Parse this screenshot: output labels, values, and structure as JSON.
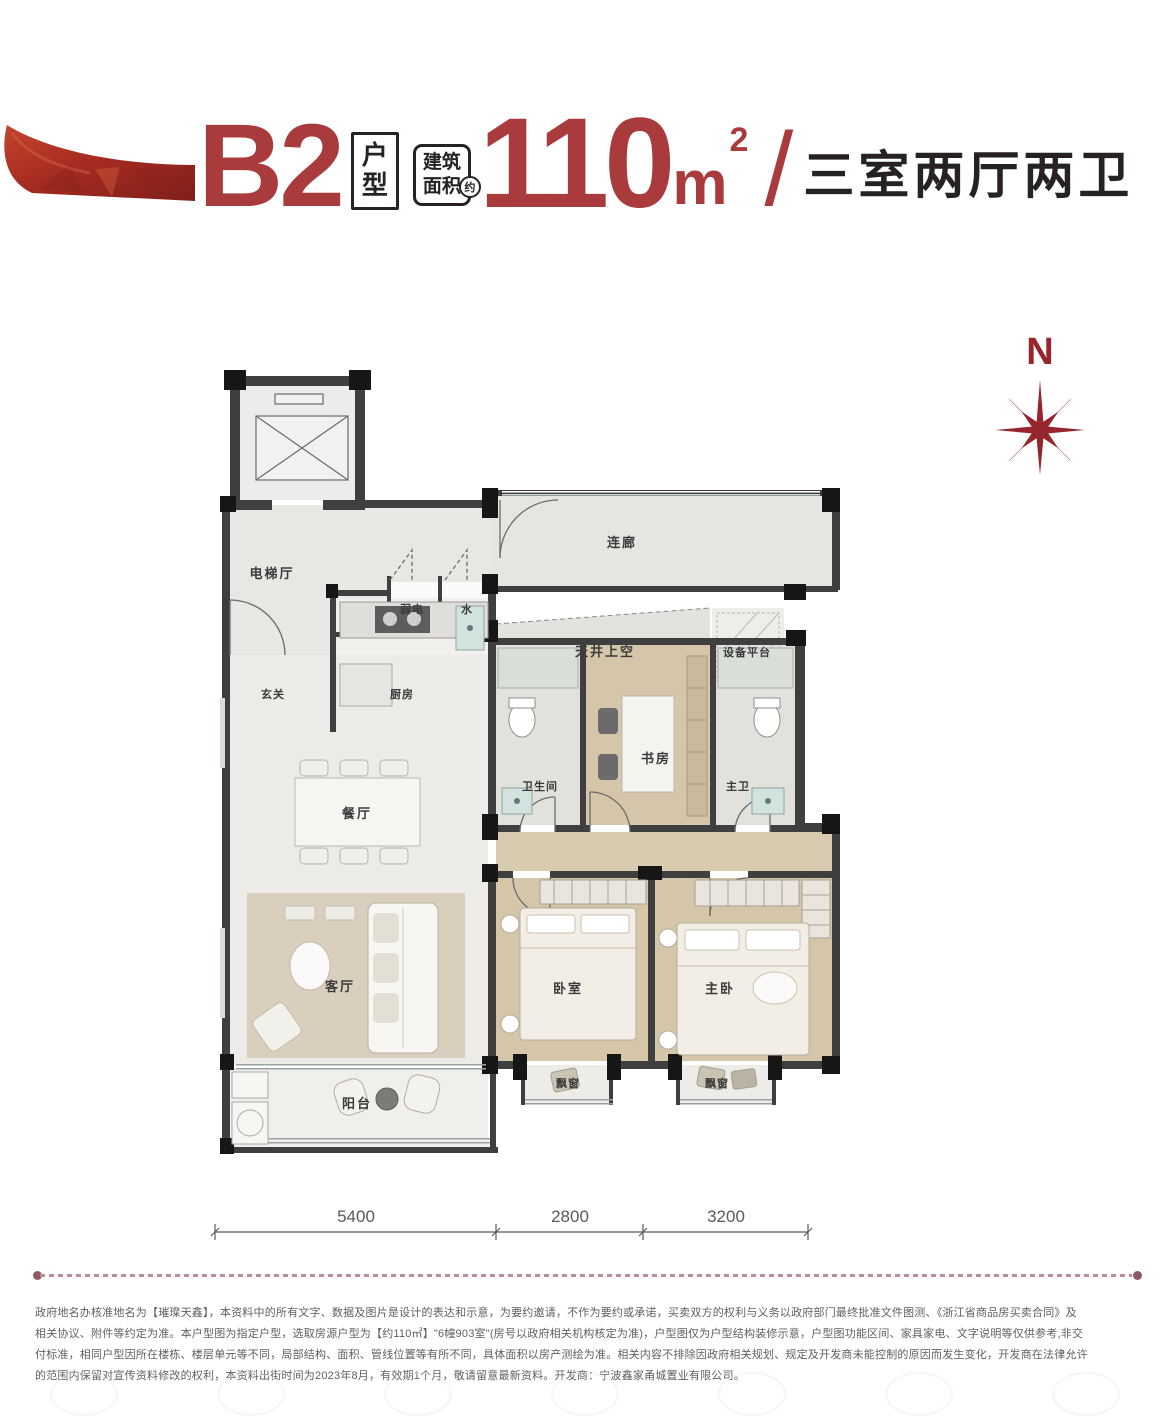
{
  "header": {
    "type_code": "B2",
    "type_label_top": "户",
    "type_label_bottom": "型",
    "area_badge_line1": "建筑",
    "area_badge_line2": "面积",
    "area_approx": "约",
    "area_value": "110",
    "area_unit": "m",
    "area_exp": "2",
    "separator": "/",
    "layout_desc": "三室两厅两卫"
  },
  "compass": {
    "label": "N"
  },
  "floorplan": {
    "rooms": [
      {
        "id": "elevator-hall",
        "label": "电梯厅"
      },
      {
        "id": "link-corridor",
        "label": "连廊"
      },
      {
        "id": "weak-electric",
        "label": "弱电"
      },
      {
        "id": "water",
        "label": "水"
      },
      {
        "id": "lightwell",
        "label": "天井上空"
      },
      {
        "id": "equipment-platform",
        "label": "设备平台"
      },
      {
        "id": "foyer",
        "label": "玄关"
      },
      {
        "id": "kitchen",
        "label": "厨房"
      },
      {
        "id": "bathroom",
        "label": "卫生间"
      },
      {
        "id": "study",
        "label": "书房"
      },
      {
        "id": "master-bath",
        "label": "主卫"
      },
      {
        "id": "dining-room",
        "label": "餐厅"
      },
      {
        "id": "living-room",
        "label": "客厅"
      },
      {
        "id": "bedroom",
        "label": "卧室"
      },
      {
        "id": "master-bedroom",
        "label": "主卧"
      },
      {
        "id": "balcony",
        "label": "阳台"
      },
      {
        "id": "bay-window-1",
        "label": "飘窗"
      },
      {
        "id": "bay-window-2",
        "label": "飘窗"
      }
    ]
  },
  "dimensions": {
    "segments": [
      {
        "label": "5400"
      },
      {
        "label": "2800"
      },
      {
        "label": "3200"
      }
    ]
  },
  "disclaimer": {
    "lines": [
      "政府地名办核准地名为【璀璨天鑫】，本资料中的所有文字、数据及图片是设计的表达和示意，为要约邀请，不作为要约或承诺，买卖双方的权利与义务以政府部门最终批准文件图测、《浙江省商品房买卖合同》及",
      "相关协议、附件等约定为准。本户型图为指定户型，选取房源户型为【约110㎡】\"6幢903室\"(房号以政府相关机构核定为准)，户型图仅为户型结构装修示意，户型图功能区间、家具家电、文字说明等仅供参考,非交",
      "付标准，相同户型因所在楼栋、楼层单元等不同，局部结构、面积、管线位置等有所不同，具体面积以房产测绘为准。相关内容不排除因政府相关规划、规定及开发商未能控制的原因而发生变化，开发商在法律允许",
      "的范围内保留对宣传资料修改的权利，本资料出街时间为2023年8月，有效期1个月，敬请留意最新资料。开发商：宁波鑫家甬城置业有限公司。"
    ]
  },
  "colors": {
    "accent_red": "#A93B3D",
    "compass_red": "#97252C",
    "title_dark": "#262223",
    "wall_dark": "#3F3F3F",
    "column_black": "#161616"
  }
}
